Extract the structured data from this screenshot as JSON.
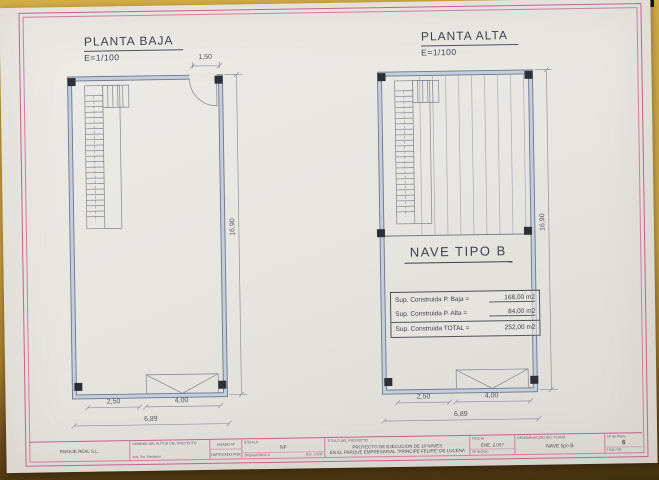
{
  "plans": {
    "left": {
      "title": "PLANTA BAJA",
      "scale": "E=1/100",
      "door_dim": "1,50",
      "dim_a": "2,50",
      "dim_b": "4,00",
      "dim_total": "6,89",
      "dim_height": "16,90"
    },
    "right": {
      "title": "PLANTA ALTA",
      "scale": "E=1/100",
      "name_label": "NAVE TIPO B",
      "dim_a": "2,50",
      "dim_b": "4,00",
      "dim_total": "6,89",
      "dim_height": "16,90",
      "area_rows": [
        {
          "label": "Sup. Construida P. Baja =",
          "value": "168,00 m2"
        },
        {
          "label": "Sup. Construida P. Alta =",
          "value": "84,00 m2"
        },
        {
          "label": "Sup. Construida TOTAL =",
          "value": "252,00 m2"
        }
      ]
    }
  },
  "title_block": {
    "promotor": "PARAJE REAL S.L.",
    "author_header": "NOMBRE DEL AUTOR DEL PROYECTO",
    "author_footer": "Arq. Tec. Redactor",
    "visado_row1": "VISADO Nº",
    "visado_row2": "RATIFICADO POR",
    "escala_header": "ESCALA",
    "escala_value": "NF",
    "escala_footer_left": "Original DIN A-3",
    "escala_footer_right": "Esc. 1/100",
    "project_header": "TITULO DEL PROYECTO",
    "project_line1": "PROYECTO DE EJECUCION DE 10 NAVES",
    "project_line2": "EN EL PARQUE EMPRESARIAL \"PRINCIPE FELIPE\" DE LUCENA",
    "date_header": "FECHA",
    "date_value": "ENE. 2.007",
    "date_footer": "Nº archivo",
    "plan_header": "DENOMINACION DEL PLANO",
    "plan_value": "NAVE tipo B",
    "num_header": "Nº de Plano",
    "num_value": "6",
    "num_footer": "Hoja / de"
  }
}
